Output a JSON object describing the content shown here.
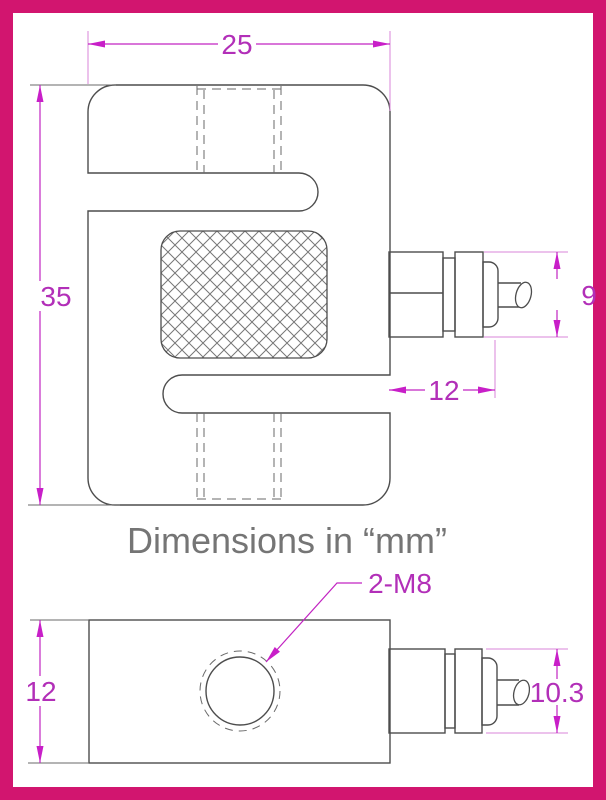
{
  "drawing": {
    "note": "Dimensions in “mm”",
    "top_view": {
      "width": "25",
      "height": "35",
      "connector_dia": "9",
      "connector_length": "12"
    },
    "bottom_view": {
      "thickness": "12",
      "connector_dia": "10.3",
      "thread_label": "2-M8"
    },
    "colors": {
      "frame": "#d2156f",
      "dimension_magenta": "#c224c2",
      "outline_gray": "#4d4d4d",
      "note_gray": "#757575"
    }
  }
}
